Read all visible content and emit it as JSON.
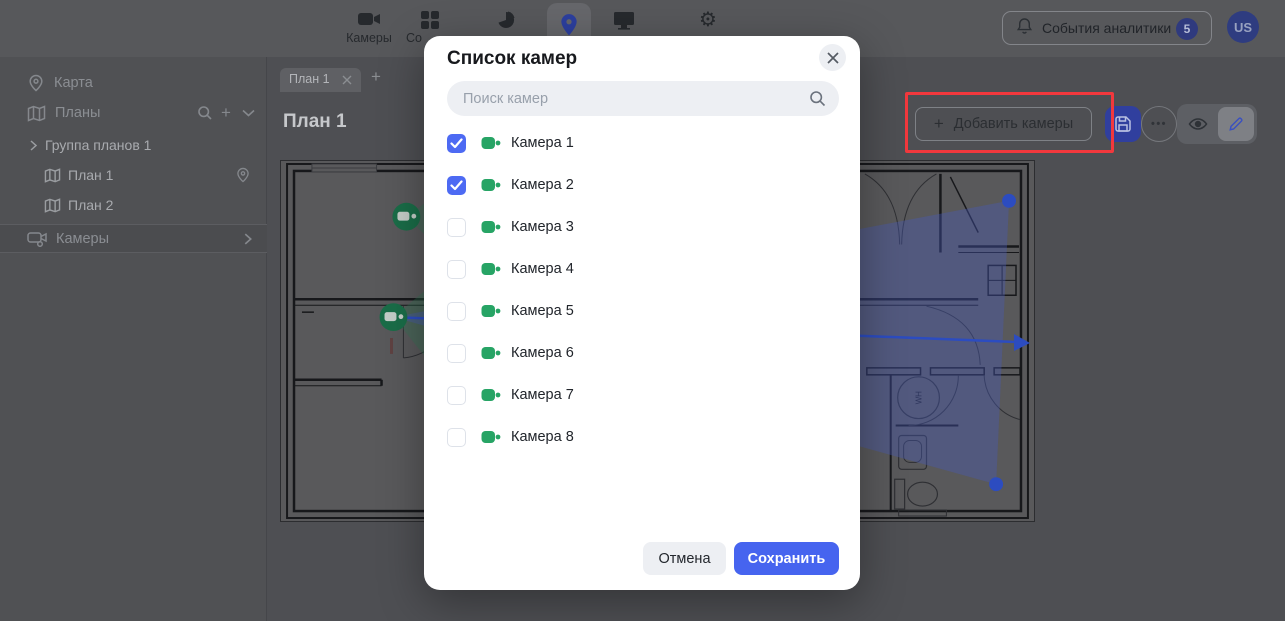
{
  "topbar": {
    "nav": [
      {
        "label": "Камеры",
        "icon": "videocam-icon",
        "active": false
      },
      {
        "label": "Со",
        "icon": "widgets-icon",
        "active": false
      },
      {
        "label": "",
        "icon": "pie-chart-icon",
        "active": false
      },
      {
        "label": "",
        "icon": "location-pin-icon",
        "active": true
      },
      {
        "label": "",
        "icon": "monitor-icon",
        "active": false
      },
      {
        "label": "",
        "icon": "gear-icon",
        "active": false
      }
    ],
    "events_button": {
      "label": "События аналитики",
      "badge": "5",
      "icon": "bell-icon"
    },
    "avatar": "US"
  },
  "sidebar": {
    "items": [
      {
        "label": "Карта",
        "icon": "location-pin-icon"
      },
      {
        "label": "Планы",
        "icon": "map-icon"
      },
      {
        "label": "Группа планов 1",
        "icon": "chevron-right-icon"
      },
      {
        "label": "План 1",
        "icon": "map-icon"
      },
      {
        "label": "План 2",
        "icon": "map-icon"
      },
      {
        "label": "Камеры",
        "icon": "cameras-group-icon"
      }
    ]
  },
  "main": {
    "tab": "План 1",
    "title": "План 1",
    "toolbar": {
      "add_cameras_label": "Добавить камеры",
      "plus_glyph": "+",
      "ellipsis_glyph": "•••"
    },
    "plan": {
      "wh_label": "WH"
    }
  },
  "glyphs": {
    "gear": "⚙",
    "tab_add": "+"
  },
  "modal": {
    "title": "Список камер",
    "search_placeholder": "Поиск камер",
    "cameras": [
      {
        "name": "Камера 1",
        "checked": true
      },
      {
        "name": "Камера 2",
        "checked": true
      },
      {
        "name": "Камера 3",
        "checked": false
      },
      {
        "name": "Камера 4",
        "checked": false
      },
      {
        "name": "Камера 5",
        "checked": false
      },
      {
        "name": "Камера 6",
        "checked": false
      },
      {
        "name": "Камера 7",
        "checked": false
      },
      {
        "name": "Камера 8",
        "checked": false
      }
    ],
    "cancel_label": "Отмена",
    "save_label": "Сохранить"
  },
  "colors": {
    "accent_blue": "#4664ef",
    "checkbox_blue": "#4d6af3",
    "camera_green": "#27a465",
    "annotation_red": "#f2383d",
    "fov_blue": "#3558e8",
    "marker_green": "#1a6d48"
  }
}
